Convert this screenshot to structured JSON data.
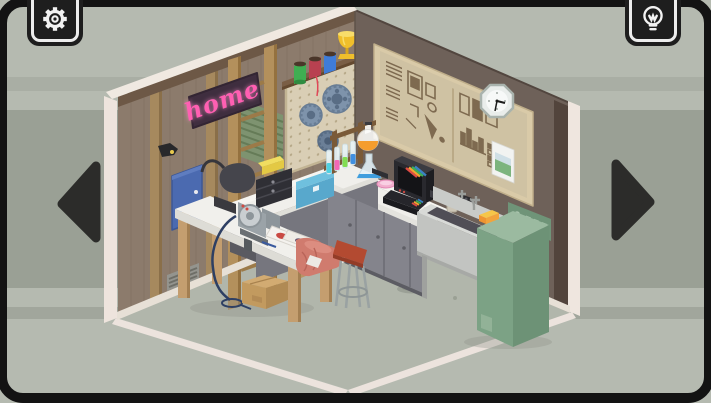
{
  "hud": {
    "settings_button": {
      "icon": "gear-icon"
    },
    "hint_button": {
      "icon": "lightbulb-icon"
    },
    "nav_left": {
      "icon": "arrow-left-icon"
    },
    "nav_right": {
      "icon": "arrow-right-icon"
    }
  },
  "room": {
    "neon_sign_text": "home",
    "neon_sign_color": "#ff5fb2",
    "clock_time": "3:30",
    "objects": [
      "neon home sign",
      "pegboard with reels",
      "thread spools",
      "trophy",
      "green shutter",
      "ladder",
      "bulletin board",
      "wall clock",
      "poster",
      "fuse box",
      "air vent",
      "chemistry set",
      "rainbow computer",
      "utility sink",
      "washing machine",
      "sponge",
      "workbench",
      "bench grinder",
      "magazines",
      "salmon cloth",
      "stool",
      "cardboard box",
      "toolbox",
      "black case",
      "bag"
    ]
  },
  "palette": {
    "background": "#b5bab0",
    "background_band": "#9aa095",
    "frame": "#131313",
    "left_wall": "#8c7b6c",
    "right_wall": "#6e6159",
    "floor": "#b1b6ab",
    "cut_edge": "#efe6df",
    "washer_green": "#7ca285",
    "stool_red": "#b04a31",
    "neon_pink": "#ff5fb2"
  }
}
